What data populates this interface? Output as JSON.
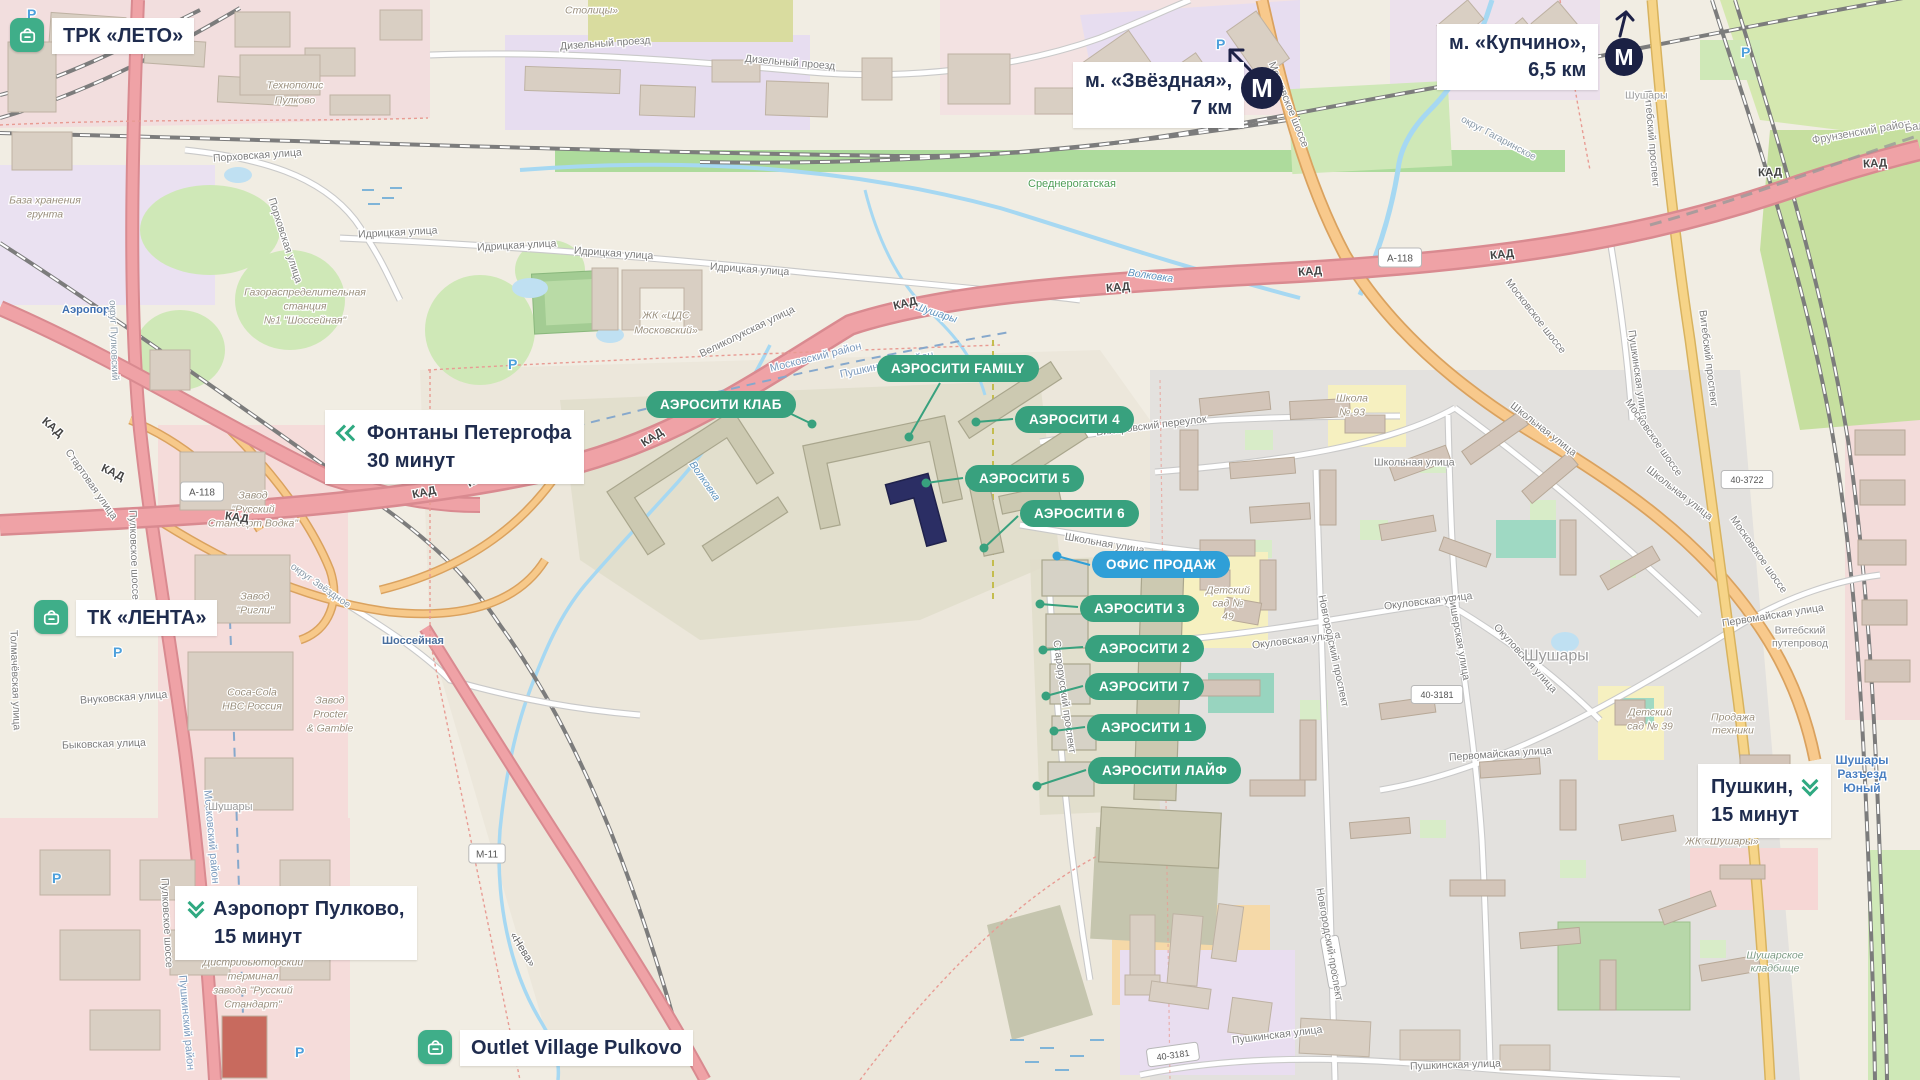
{
  "overlays": {
    "colors": {
      "green": "#38a17e",
      "blue": "#2f9fd7",
      "navy": "#1f2c4e",
      "icon_green": "#3fae89"
    },
    "poi": [
      {
        "label": "ТРК «ЛЕТО»"
      },
      {
        "label": "ТК «ЛЕНТА»"
      },
      {
        "label": "Outlet Village Pulkovo"
      }
    ],
    "metro": [
      {
        "name": "м. «Звёздная»,",
        "distance": "7 км"
      },
      {
        "name": "м. «Купчино»,",
        "distance": "6,5 км"
      }
    ],
    "routes": [
      {
        "line1": "Фонтаны Петергофа",
        "line2": "30 минут"
      },
      {
        "line1": "Аэропорт Пулково,",
        "line2": "15 минут"
      },
      {
        "line1": "Пушкин,",
        "line2": "15 минут"
      }
    ],
    "sales_office": {
      "label": "ОФИС ПРОДАЖ",
      "x": 1092,
      "y": 551
    },
    "pills": [
      {
        "label": "АЭРОСИТИ FAMILY",
        "x": 877,
        "y": 355
      },
      {
        "label": "АЭРОСИТИ КЛАБ",
        "x": 646,
        "y": 391
      },
      {
        "label": "АЭРОСИТИ 4",
        "x": 1015,
        "y": 406
      },
      {
        "label": "АЭРОСИТИ 5",
        "x": 965,
        "y": 465
      },
      {
        "label": "АЭРОСИТИ 6",
        "x": 1020,
        "y": 500
      },
      {
        "label": "АЭРОСИТИ 3",
        "x": 1080,
        "y": 595
      },
      {
        "label": "АЭРОСИТИ 2",
        "x": 1085,
        "y": 635
      },
      {
        "label": "АЭРОСИТИ 7",
        "x": 1085,
        "y": 673
      },
      {
        "label": "АЭРОСИТИ 1",
        "x": 1087,
        "y": 714
      },
      {
        "label": "АЭРОСИТИ ЛАЙФ",
        "x": 1088,
        "y": 757
      }
    ],
    "connectors": [
      {
        "x1": 783,
        "y1": 410,
        "x2": 812,
        "y2": 424
      },
      {
        "x1": 940,
        "y1": 383,
        "x2": 909,
        "y2": 437
      },
      {
        "x1": 1013,
        "y1": 419,
        "x2": 976,
        "y2": 422
      },
      {
        "x1": 963,
        "y1": 478,
        "x2": 926,
        "y2": 483
      },
      {
        "x1": 1018,
        "y1": 516,
        "x2": 984,
        "y2": 548
      },
      {
        "x1": 1090,
        "y1": 565,
        "x2": 1057,
        "y2": 556,
        "c": "blue"
      },
      {
        "x1": 1078,
        "y1": 607,
        "x2": 1040,
        "y2": 604
      },
      {
        "x1": 1083,
        "y1": 647,
        "x2": 1043,
        "y2": 650
      },
      {
        "x1": 1083,
        "y1": 686,
        "x2": 1046,
        "y2": 696
      },
      {
        "x1": 1085,
        "y1": 727,
        "x2": 1054,
        "y2": 731
      },
      {
        "x1": 1086,
        "y1": 770,
        "x2": 1037,
        "y2": 786
      }
    ]
  },
  "map_labels": [
    {
      "t": "Дизельный проезд",
      "x": 560,
      "y": 46,
      "r": -4
    },
    {
      "t": "Дизельный проезд",
      "x": 745,
      "y": 58,
      "r": 5
    },
    {
      "t": "Столицы»",
      "x": 565,
      "y": 10,
      "c": "#9a8f7d",
      "i": 1
    },
    {
      "t": "Порховская улица",
      "x": 213,
      "y": 158,
      "r": -4
    },
    {
      "t": "Порховская улица",
      "x": 272,
      "y": 198,
      "r": 72
    },
    {
      "t": "Идрицкая улица",
      "x": 358,
      "y": 234,
      "r": -3
    },
    {
      "t": "Идрицкая улица",
      "x": 477,
      "y": 247,
      "r": -3
    },
    {
      "t": "Идрицкая улица",
      "x": 574,
      "y": 250,
      "r": 4
    },
    {
      "t": "Идрицкая улица",
      "x": 710,
      "y": 266,
      "r": 4
    },
    {
      "t": "База хранения",
      "x": 45,
      "y": 200,
      "c": "#9a8f7d",
      "i": 1,
      "a": "m"
    },
    {
      "t": "грунта",
      "x": 45,
      "y": 214,
      "c": "#9a8f7d",
      "i": 1,
      "a": "m"
    },
    {
      "t": "Газораспределительная",
      "x": 305,
      "y": 292,
      "c": "#9a8f7d",
      "i": 1,
      "a": "m"
    },
    {
      "t": "станция",
      "x": 305,
      "y": 306,
      "c": "#9a8f7d",
      "i": 1,
      "a": "m"
    },
    {
      "t": "№1 \"Шоссейная\"",
      "x": 305,
      "y": 320,
      "c": "#9a8f7d",
      "i": 1,
      "a": "m"
    },
    {
      "t": "Технополис",
      "x": 295,
      "y": 85,
      "c": "#9a8f7d",
      "i": 1,
      "a": "m"
    },
    {
      "t": "Пулково",
      "x": 295,
      "y": 100,
      "c": "#9a8f7d",
      "i": 1,
      "a": "m"
    },
    {
      "t": "Аэропорт",
      "x": 62,
      "y": 309,
      "s": 11,
      "c": "#3e6fb0",
      "b": 1
    },
    {
      "t": "округ Пулковский",
      "x": 113,
      "y": 300,
      "r": 88,
      "s": 10,
      "c": "#8a9aa8"
    },
    {
      "t": "округ Звёздное",
      "x": 292,
      "y": 565,
      "r": 35,
      "s": 10,
      "c": "#8a9aa8"
    },
    {
      "t": "округ Гагаринское",
      "x": 1462,
      "y": 118,
      "r": 28,
      "s": 10,
      "c": "#8a9aa8"
    },
    {
      "t": "Среднерогатская",
      "x": 1028,
      "y": 183,
      "s": 11,
      "c": "#4f9e57"
    },
    {
      "t": "Волковка",
      "x": 1128,
      "y": 272,
      "r": 8,
      "c": "#5f93bd",
      "i": 1
    },
    {
      "t": "Волковка",
      "x": 692,
      "y": 462,
      "r": 55,
      "c": "#5f93bd",
      "i": 1
    },
    {
      "t": "Шушары",
      "x": 916,
      "y": 306,
      "r": 18,
      "c": "#5f93bd",
      "i": 1
    },
    {
      "t": "Московский район",
      "x": 770,
      "y": 368,
      "r": -14,
      "s": 11,
      "c": "#7d9bbd"
    },
    {
      "t": "Пушкинский район",
      "x": 840,
      "y": 374,
      "r": -12,
      "s": 11,
      "c": "#7d9bbd"
    },
    {
      "t": "Московский район",
      "x": 208,
      "y": 790,
      "r": 85,
      "s": 11,
      "c": "#7d9bbd"
    },
    {
      "t": "Пушкинский район",
      "x": 183,
      "y": 975,
      "r": 85,
      "s": 11,
      "c": "#7d9bbd"
    },
    {
      "t": "Шоссейная",
      "x": 382,
      "y": 640,
      "s": 11,
      "c": "#4a6f9e",
      "b": 1
    },
    {
      "t": "Пулковское шоссе",
      "x": 133,
      "y": 510,
      "r": 88
    },
    {
      "t": "Пулковское шоссе",
      "x": 165,
      "y": 878,
      "r": 87
    },
    {
      "t": "Стартовая улица",
      "x": 68,
      "y": 450,
      "r": 55
    },
    {
      "t": "Внуковская улица",
      "x": 80,
      "y": 700,
      "r": -4
    },
    {
      "t": "Быковская улица",
      "x": 62,
      "y": 745,
      "r": -2
    },
    {
      "t": "Толмачёвская улица",
      "x": 14,
      "y": 630,
      "r": 88
    },
    {
      "t": "Великолукская улица",
      "x": 700,
      "y": 354,
      "r": -26
    },
    {
      "t": "ЖК «ЦДС",
      "x": 666,
      "y": 315,
      "c": "#9a8f7d",
      "i": 1,
      "a": "m"
    },
    {
      "t": "Московский»",
      "x": 666,
      "y": 330,
      "c": "#9a8f7d",
      "i": 1,
      "a": "m"
    },
    {
      "t": "Завод",
      "x": 253,
      "y": 495,
      "c": "#9a8f7d",
      "i": 1,
      "a": "m"
    },
    {
      "t": "\"Русский",
      "x": 253,
      "y": 509,
      "c": "#9a8f7d",
      "i": 1,
      "a": "m"
    },
    {
      "t": "Стандарт Водка\"",
      "x": 253,
      "y": 523,
      "c": "#9a8f7d",
      "i": 1,
      "a": "m"
    },
    {
      "t": "Завод",
      "x": 255,
      "y": 596,
      "c": "#9a8f7d",
      "i": 1,
      "a": "m"
    },
    {
      "t": "\"Ригли\"",
      "x": 255,
      "y": 610,
      "c": "#9a8f7d",
      "i": 1,
      "a": "m"
    },
    {
      "t": "Coca-Cola",
      "x": 252,
      "y": 692,
      "c": "#9a8f7d",
      "i": 1,
      "a": "m"
    },
    {
      "t": "HBC Россия",
      "x": 252,
      "y": 706,
      "c": "#9a8f7d",
      "i": 1,
      "a": "m"
    },
    {
      "t": "Завод",
      "x": 330,
      "y": 700,
      "c": "#9a8f7d",
      "i": 1,
      "a": "m"
    },
    {
      "t": "Procter",
      "x": 330,
      "y": 714,
      "c": "#9a8f7d",
      "i": 1,
      "a": "m"
    },
    {
      "t": "& Gamble",
      "x": 330,
      "y": 728,
      "c": "#9a8f7d",
      "i": 1,
      "a": "m"
    },
    {
      "t": "Дистрибьюторский",
      "x": 253,
      "y": 962,
      "c": "#9a8f7d",
      "i": 1,
      "a": "m"
    },
    {
      "t": "терминал",
      "x": 253,
      "y": 976,
      "c": "#9a8f7d",
      "i": 1,
      "a": "m"
    },
    {
      "t": "завода \"Русский",
      "x": 253,
      "y": 990,
      "c": "#9a8f7d",
      "i": 1,
      "a": "m"
    },
    {
      "t": "Стандарт\"",
      "x": 253,
      "y": 1004,
      "c": "#9a8f7d",
      "i": 1,
      "a": "m"
    },
    {
      "t": "Шушары",
      "x": 208,
      "y": 806,
      "s": 11,
      "c": "#999999"
    },
    {
      "t": "КАД",
      "x": 53,
      "y": 427,
      "r": 40,
      "s": 11.5,
      "b": 1,
      "c": "#444444",
      "a": "m"
    },
    {
      "t": "КАД",
      "x": 113,
      "y": 472,
      "r": 25,
      "s": 11.5,
      "b": 1,
      "c": "#444444",
      "a": "m"
    },
    {
      "t": "КАД",
      "x": 237,
      "y": 517,
      "r": 8,
      "s": 11.5,
      "b": 1,
      "c": "#444444",
      "a": "m"
    },
    {
      "t": "КАД",
      "x": 424,
      "y": 492,
      "r": -12,
      "s": 11.5,
      "b": 1,
      "c": "#444444",
      "a": "m"
    },
    {
      "t": "КАД",
      "x": 478,
      "y": 478,
      "r": -28,
      "s": 11.5,
      "b": 1,
      "c": "#444444",
      "a": "m"
    },
    {
      "t": "КАД",
      "x": 652,
      "y": 437,
      "r": -33,
      "s": 11.5,
      "b": 1,
      "c": "#444444",
      "a": "m"
    },
    {
      "t": "КАД",
      "x": 905,
      "y": 303,
      "r": -14,
      "s": 11.5,
      "b": 1,
      "c": "#444444",
      "a": "m"
    },
    {
      "t": "КАД",
      "x": 1118,
      "y": 287,
      "r": -5,
      "s": 11.5,
      "b": 1,
      "c": "#444444",
      "a": "m"
    },
    {
      "t": "КАД",
      "x": 1310,
      "y": 271,
      "r": -4,
      "s": 11.5,
      "b": 1,
      "c": "#444444",
      "a": "m"
    },
    {
      "t": "КАД",
      "x": 1502,
      "y": 254,
      "r": -6,
      "s": 11.5,
      "b": 1,
      "c": "#444444",
      "a": "m"
    },
    {
      "t": "КАД",
      "x": 1770,
      "y": 172,
      "r": -2,
      "s": 11.5,
      "b": 1,
      "c": "#444444",
      "a": "m"
    },
    {
      "t": "КАД",
      "x": 1875,
      "y": 163,
      "r": -3,
      "s": 11.5,
      "b": 1,
      "c": "#444444",
      "a": "m"
    },
    {
      "t": "А-118",
      "x": 202,
      "y": 492,
      "sh": 1,
      "s": 10,
      "c": "#555555",
      "a": "m"
    },
    {
      "t": "А-118",
      "x": 1400,
      "y": 258,
      "sh": 1,
      "s": 10,
      "c": "#555555",
      "a": "m"
    },
    {
      "t": "М-11",
      "x": 487,
      "y": 854,
      "sh": 1,
      "s": 10,
      "c": "#555555",
      "a": "m"
    },
    {
      "t": "«Нева»",
      "x": 513,
      "y": 933,
      "r": 58,
      "s": 11,
      "c": "#666666"
    },
    {
      "t": "40-3722",
      "x": 1747,
      "y": 480,
      "sh": 1,
      "s": 9,
      "c": "#555555",
      "a": "m"
    },
    {
      "t": "40-3181",
      "x": 1437,
      "y": 695,
      "sh": 1,
      "s": 9,
      "c": "#555555",
      "a": "m"
    },
    {
      "t": "40-3582",
      "x": 1333,
      "y": 962,
      "sh": 1,
      "s": 9,
      "r": 80,
      "c": "#555555",
      "a": "m"
    },
    {
      "t": "40-3181",
      "x": 1173,
      "y": 1055,
      "sh": 1,
      "s": 9,
      "r": -8,
      "c": "#555555",
      "a": "m"
    },
    {
      "t": "Школьная улица",
      "x": 1065,
      "y": 536,
      "r": 10
    },
    {
      "t": "Школьная улица",
      "x": 1374,
      "y": 462
    },
    {
      "t": "Школьная улица",
      "x": 1512,
      "y": 404,
      "r": 38
    },
    {
      "t": "Школьная улица",
      "x": 1648,
      "y": 468,
      "r": 38
    },
    {
      "t": "Вилеровский переулок",
      "x": 1096,
      "y": 432,
      "r": -7
    },
    {
      "t": "Старорусский проспект",
      "x": 1057,
      "y": 640,
      "r": 82
    },
    {
      "t": "Окуловская улица",
      "x": 1252,
      "y": 645,
      "r": -7
    },
    {
      "t": "Окуловская улица",
      "x": 1384,
      "y": 606,
      "r": -7
    },
    {
      "t": "Окуловская улица",
      "x": 1496,
      "y": 625,
      "r": 48
    },
    {
      "t": "Новгородский проспект",
      "x": 1322,
      "y": 595,
      "r": 78
    },
    {
      "t": "Новгородский проспект",
      "x": 1320,
      "y": 888,
      "r": 80
    },
    {
      "t": "Первомайская улица",
      "x": 1449,
      "y": 757,
      "r": -4
    },
    {
      "t": "Первомайская улица",
      "x": 1722,
      "y": 623,
      "r": -9
    },
    {
      "t": "Пушкинская улица",
      "x": 1232,
      "y": 1040,
      "r": -7
    },
    {
      "t": "Пушкинская улица",
      "x": 1410,
      "y": 1066,
      "r": -2
    },
    {
      "t": "Пушкинская улица",
      "x": 1632,
      "y": 330,
      "r": 82
    },
    {
      "t": "Вишерская улица",
      "x": 1452,
      "y": 595,
      "r": 80
    },
    {
      "t": "Шушары",
      "x": 1524,
      "y": 655,
      "s": 16,
      "c": "#9b9b9b"
    },
    {
      "t": "Школа",
      "x": 1352,
      "y": 398,
      "c": "#9a8f7d",
      "i": 1,
      "a": "m"
    },
    {
      "t": "№ 93",
      "x": 1352,
      "y": 412,
      "c": "#9a8f7d",
      "i": 1,
      "a": "m"
    },
    {
      "t": "Детский",
      "x": 1228,
      "y": 590,
      "c": "#9a8f7d",
      "i": 1,
      "a": "m"
    },
    {
      "t": "сад №",
      "x": 1228,
      "y": 603,
      "c": "#9a8f7d",
      "i": 1,
      "a": "m"
    },
    {
      "t": "49",
      "x": 1228,
      "y": 616,
      "c": "#9a8f7d",
      "i": 1,
      "a": "m"
    },
    {
      "t": "Детский",
      "x": 1650,
      "y": 712,
      "c": "#9a8f7d",
      "i": 1,
      "a": "m"
    },
    {
      "t": "сад № 39",
      "x": 1650,
      "y": 726,
      "c": "#9a8f7d",
      "i": 1,
      "a": "m"
    },
    {
      "t": "ЖК «Шушары»",
      "x": 1722,
      "y": 841,
      "c": "#9a8f7d",
      "i": 1,
      "a": "m"
    },
    {
      "t": "Продажа",
      "x": 1733,
      "y": 717,
      "c": "#9a8f7d",
      "i": 1,
      "a": "m"
    },
    {
      "t": "техники",
      "x": 1733,
      "y": 730,
      "c": "#9a8f7d",
      "i": 1,
      "a": "m"
    },
    {
      "t": "Шушарское",
      "x": 1775,
      "y": 955,
      "c": "#7d9b85",
      "i": 1,
      "a": "m"
    },
    {
      "t": "кладбище",
      "x": 1775,
      "y": 968,
      "c": "#7d9b85",
      "i": 1,
      "a": "m"
    },
    {
      "t": "Витебский",
      "x": 1800,
      "y": 630,
      "c": "#888888",
      "a": "m"
    },
    {
      "t": "путепровод",
      "x": 1800,
      "y": 643,
      "c": "#888888",
      "a": "m"
    },
    {
      "t": "Витебский проспект",
      "x": 1648,
      "y": 90,
      "r": 85
    },
    {
      "t": "Витебский проспект",
      "x": 1703,
      "y": 310,
      "r": 83
    },
    {
      "t": "Фрунзенский район",
      "x": 1812,
      "y": 140,
      "r": -10,
      "s": 11,
      "c": "#8a8a8a"
    },
    {
      "t": "Балканская",
      "x": 1905,
      "y": 128,
      "r": -10,
      "s": 11,
      "c": "#8a8a8a"
    },
    {
      "t": "Московское шоссе",
      "x": 1272,
      "y": 62,
      "r": 68
    },
    {
      "t": "Московское шоссе",
      "x": 1508,
      "y": 280,
      "r": 52
    },
    {
      "t": "Московское шоссе",
      "x": 1628,
      "y": 400,
      "r": 55
    },
    {
      "t": "Московское шоссе",
      "x": 1733,
      "y": 517,
      "r": 55
    },
    {
      "t": "Шушары",
      "x": 1625,
      "y": 95,
      "c": "#999999"
    },
    {
      "t": "Шушары",
      "x": 1862,
      "y": 760,
      "s": 12,
      "c": "#4a7fc1",
      "b": 1,
      "a": "m"
    },
    {
      "t": "Разъезд",
      "x": 1862,
      "y": 774,
      "s": 12,
      "c": "#4a7fc1",
      "b": 1,
      "a": "m"
    },
    {
      "t": "Юный",
      "x": 1862,
      "y": 788,
      "s": 12,
      "c": "#4a7fc1",
      "b": 1,
      "a": "m"
    },
    {
      "t": "Р",
      "x": 27,
      "y": 14,
      "s": 14,
      "b": 1,
      "c": "#4da0dc"
    },
    {
      "t": "Р",
      "x": 508,
      "y": 364,
      "s": 14,
      "b": 1,
      "c": "#4da0dc"
    },
    {
      "t": "Р",
      "x": 1216,
      "y": 44,
      "s": 14,
      "b": 1,
      "c": "#4da0dc"
    },
    {
      "t": "Р",
      "x": 113,
      "y": 652,
      "s": 14,
      "b": 1,
      "c": "#4da0dc"
    },
    {
      "t": "Р",
      "x": 52,
      "y": 878,
      "s": 14,
      "b": 1,
      "c": "#4da0dc"
    },
    {
      "t": "Р",
      "x": 295,
      "y": 1052,
      "s": 14,
      "b": 1,
      "c": "#4da0dc"
    },
    {
      "t": "Р",
      "x": 1741,
      "y": 52,
      "s": 14,
      "b": 1,
      "c": "#4da0dc"
    }
  ]
}
